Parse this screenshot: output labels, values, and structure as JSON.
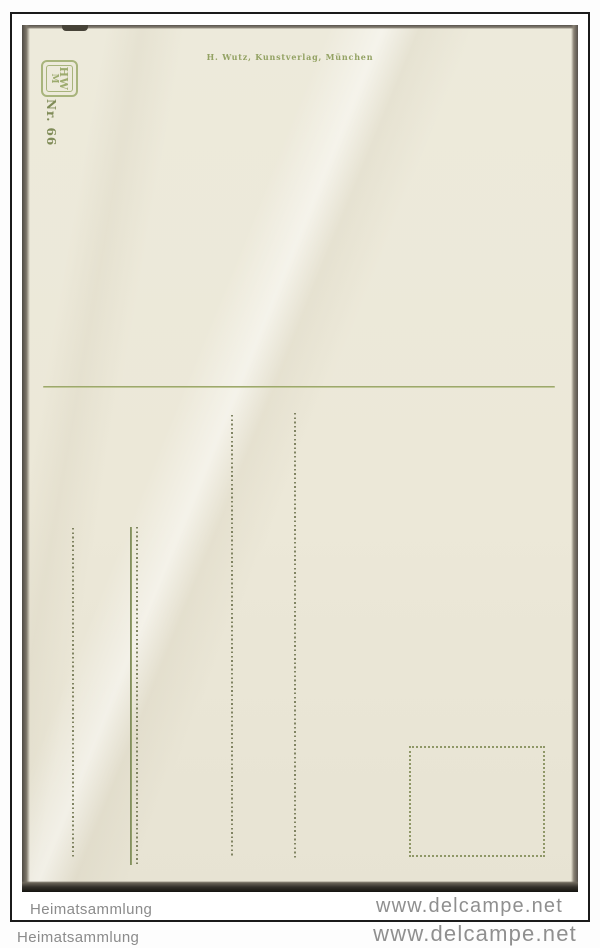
{
  "card": {
    "publisher_imprint": "H. Wutz, Kunstverlag, München",
    "series_number": "Nr. 66",
    "monogram_line1": "HW",
    "monogram_line2": "M"
  },
  "watermarks": {
    "inner": {
      "left": "Heimatsammlung",
      "right": "www.delcampe.net"
    },
    "outer": {
      "left": "Heimatsammlung",
      "right": "www.delcampe.net"
    }
  },
  "colors": {
    "print_green": "#93a263",
    "card_cream": "#ece8d8",
    "watermark_gray": "#8b8b8b",
    "frame_black": "#1b1b1b",
    "card_edge_dark": "#33302a"
  }
}
